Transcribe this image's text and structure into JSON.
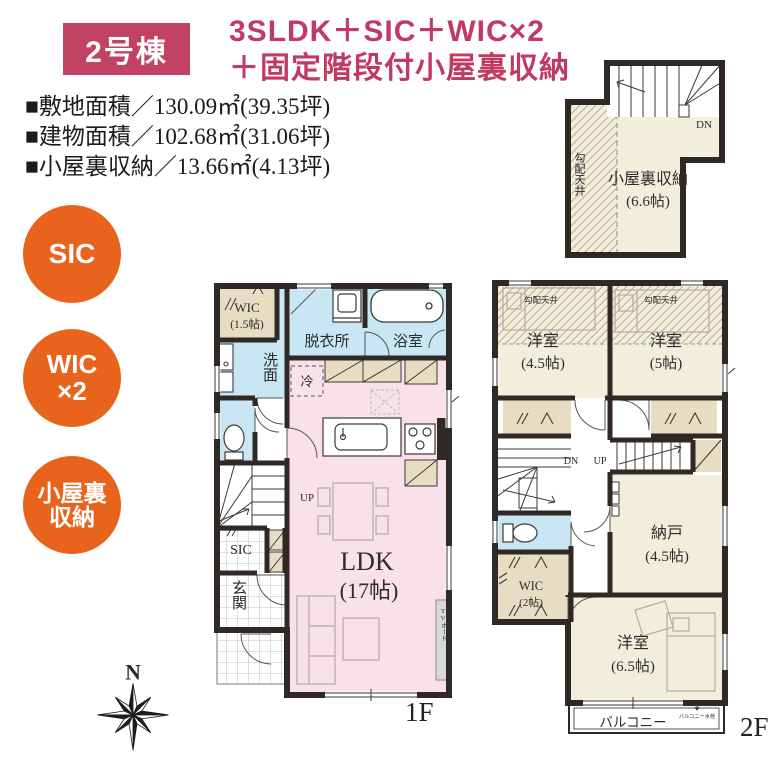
{
  "header": {
    "badge": "2号棟",
    "title1": "3SLDK＋SIC＋WIC×2",
    "title2": "＋固定階段付小屋裏収納",
    "specs": [
      "■敷地面積／130.09㎡(39.35坪)",
      "■建物面積／102.68㎡(31.06坪)",
      "■小屋裏収納／13.66㎡(4.13坪)"
    ]
  },
  "features": [
    {
      "line1": "SIC",
      "line2": ""
    },
    {
      "line1": "WIC",
      "line2": "×2"
    },
    {
      "line1": "小屋裏",
      "line2": "収納"
    }
  ],
  "attic": {
    "name": "小屋裏収納",
    "size": "(6.6帖)",
    "sloped": "勾配天井",
    "dn": "DN"
  },
  "f1": {
    "label": "1F",
    "wic": "WIC",
    "wic_size": "(1.5帖)",
    "dressing": "脱衣所",
    "bath": "浴室",
    "wash": "洗面",
    "fridge": "冷",
    "up": "UP",
    "sic": "SIC",
    "entrance": "玄関",
    "ldk": "LDK",
    "ldk_size": "(17帖)",
    "tv": "TVボード"
  },
  "f2": {
    "label": "2F",
    "sloped_l": "勾配天井",
    "sloped_r": "勾配天井",
    "bed1": "洋室",
    "bed1_size": "(4.5帖)",
    "bed2": "洋室",
    "bed2_size": "(5帖)",
    "dn": "DN",
    "up": "UP",
    "storage": "納戸",
    "storage_size": "(4.5帖)",
    "wic": "WIC",
    "wic_size": "(2帖)",
    "bed3": "洋室",
    "bed3_size": "(6.5帖)",
    "balcony": "バルコニー",
    "tap": "バルコニー水栓"
  },
  "compass": {
    "n": "N"
  },
  "colors": {
    "accent_crimson": "#c24264",
    "accent_orange": "#e8641c",
    "wall": "#302824",
    "room_cream": "#f2eedc",
    "closet_beige": "#e7ddc3",
    "wet_blue": "#c9e6f4",
    "ldk_pink": "#f9e0ea"
  }
}
